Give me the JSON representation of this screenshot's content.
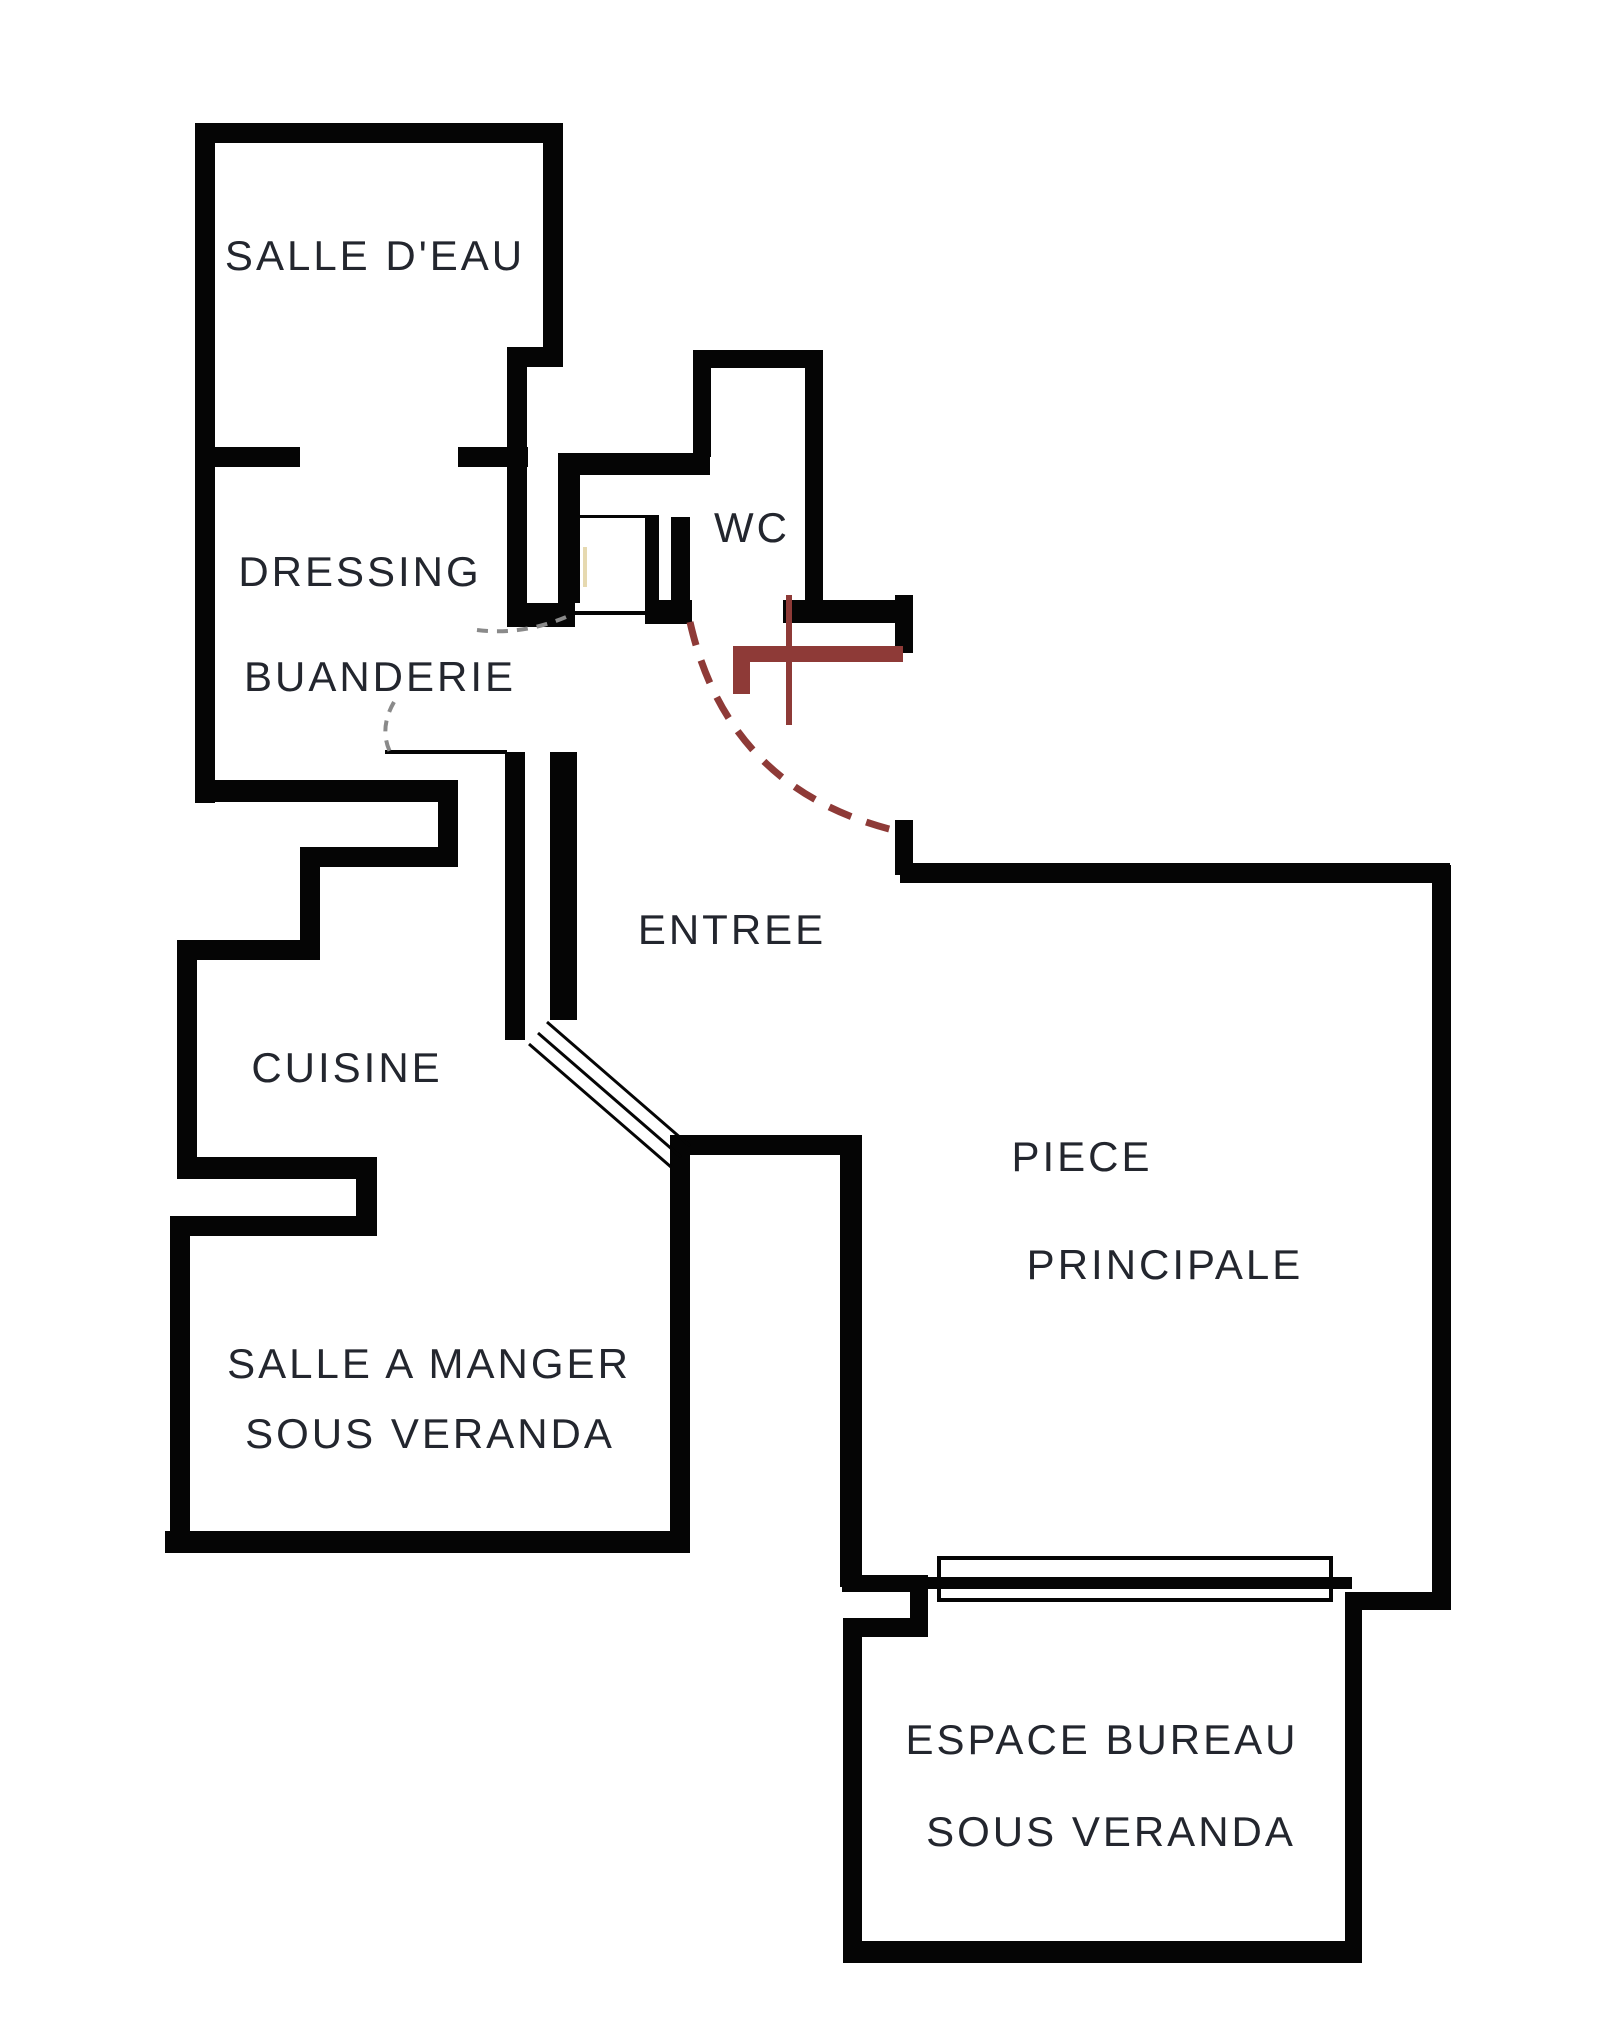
{
  "canvas": {
    "background": "#ffffff",
    "wall_color": "#050505",
    "text_color": "#23262e"
  },
  "rooms": {
    "salle_deau": {
      "label": "SALLE D'EAU"
    },
    "dressing": {
      "label": "DRESSING"
    },
    "buanderie": {
      "label": "BUANDERIE"
    },
    "wc": {
      "label": "WC"
    },
    "entree": {
      "label": "ENTREE"
    },
    "cuisine": {
      "label": "CUISINE"
    },
    "salle_a_manger": {
      "line1": "SALLE A MANGER",
      "line2": "SOUS VERANDA"
    },
    "piece_principale": {
      "line1": "PIECE",
      "line2": "PRINCIPALE"
    },
    "espace_bureau": {
      "line1": "ESPACE BUREAU",
      "line2": "SOUS VERANDA"
    }
  },
  "doors": {
    "entry_door_color": "#8e3a37",
    "swing_dash_color": "#8a8a8a",
    "diagonal_door_color": "#050505",
    "minor_mark_color": "#e6d9b0"
  }
}
